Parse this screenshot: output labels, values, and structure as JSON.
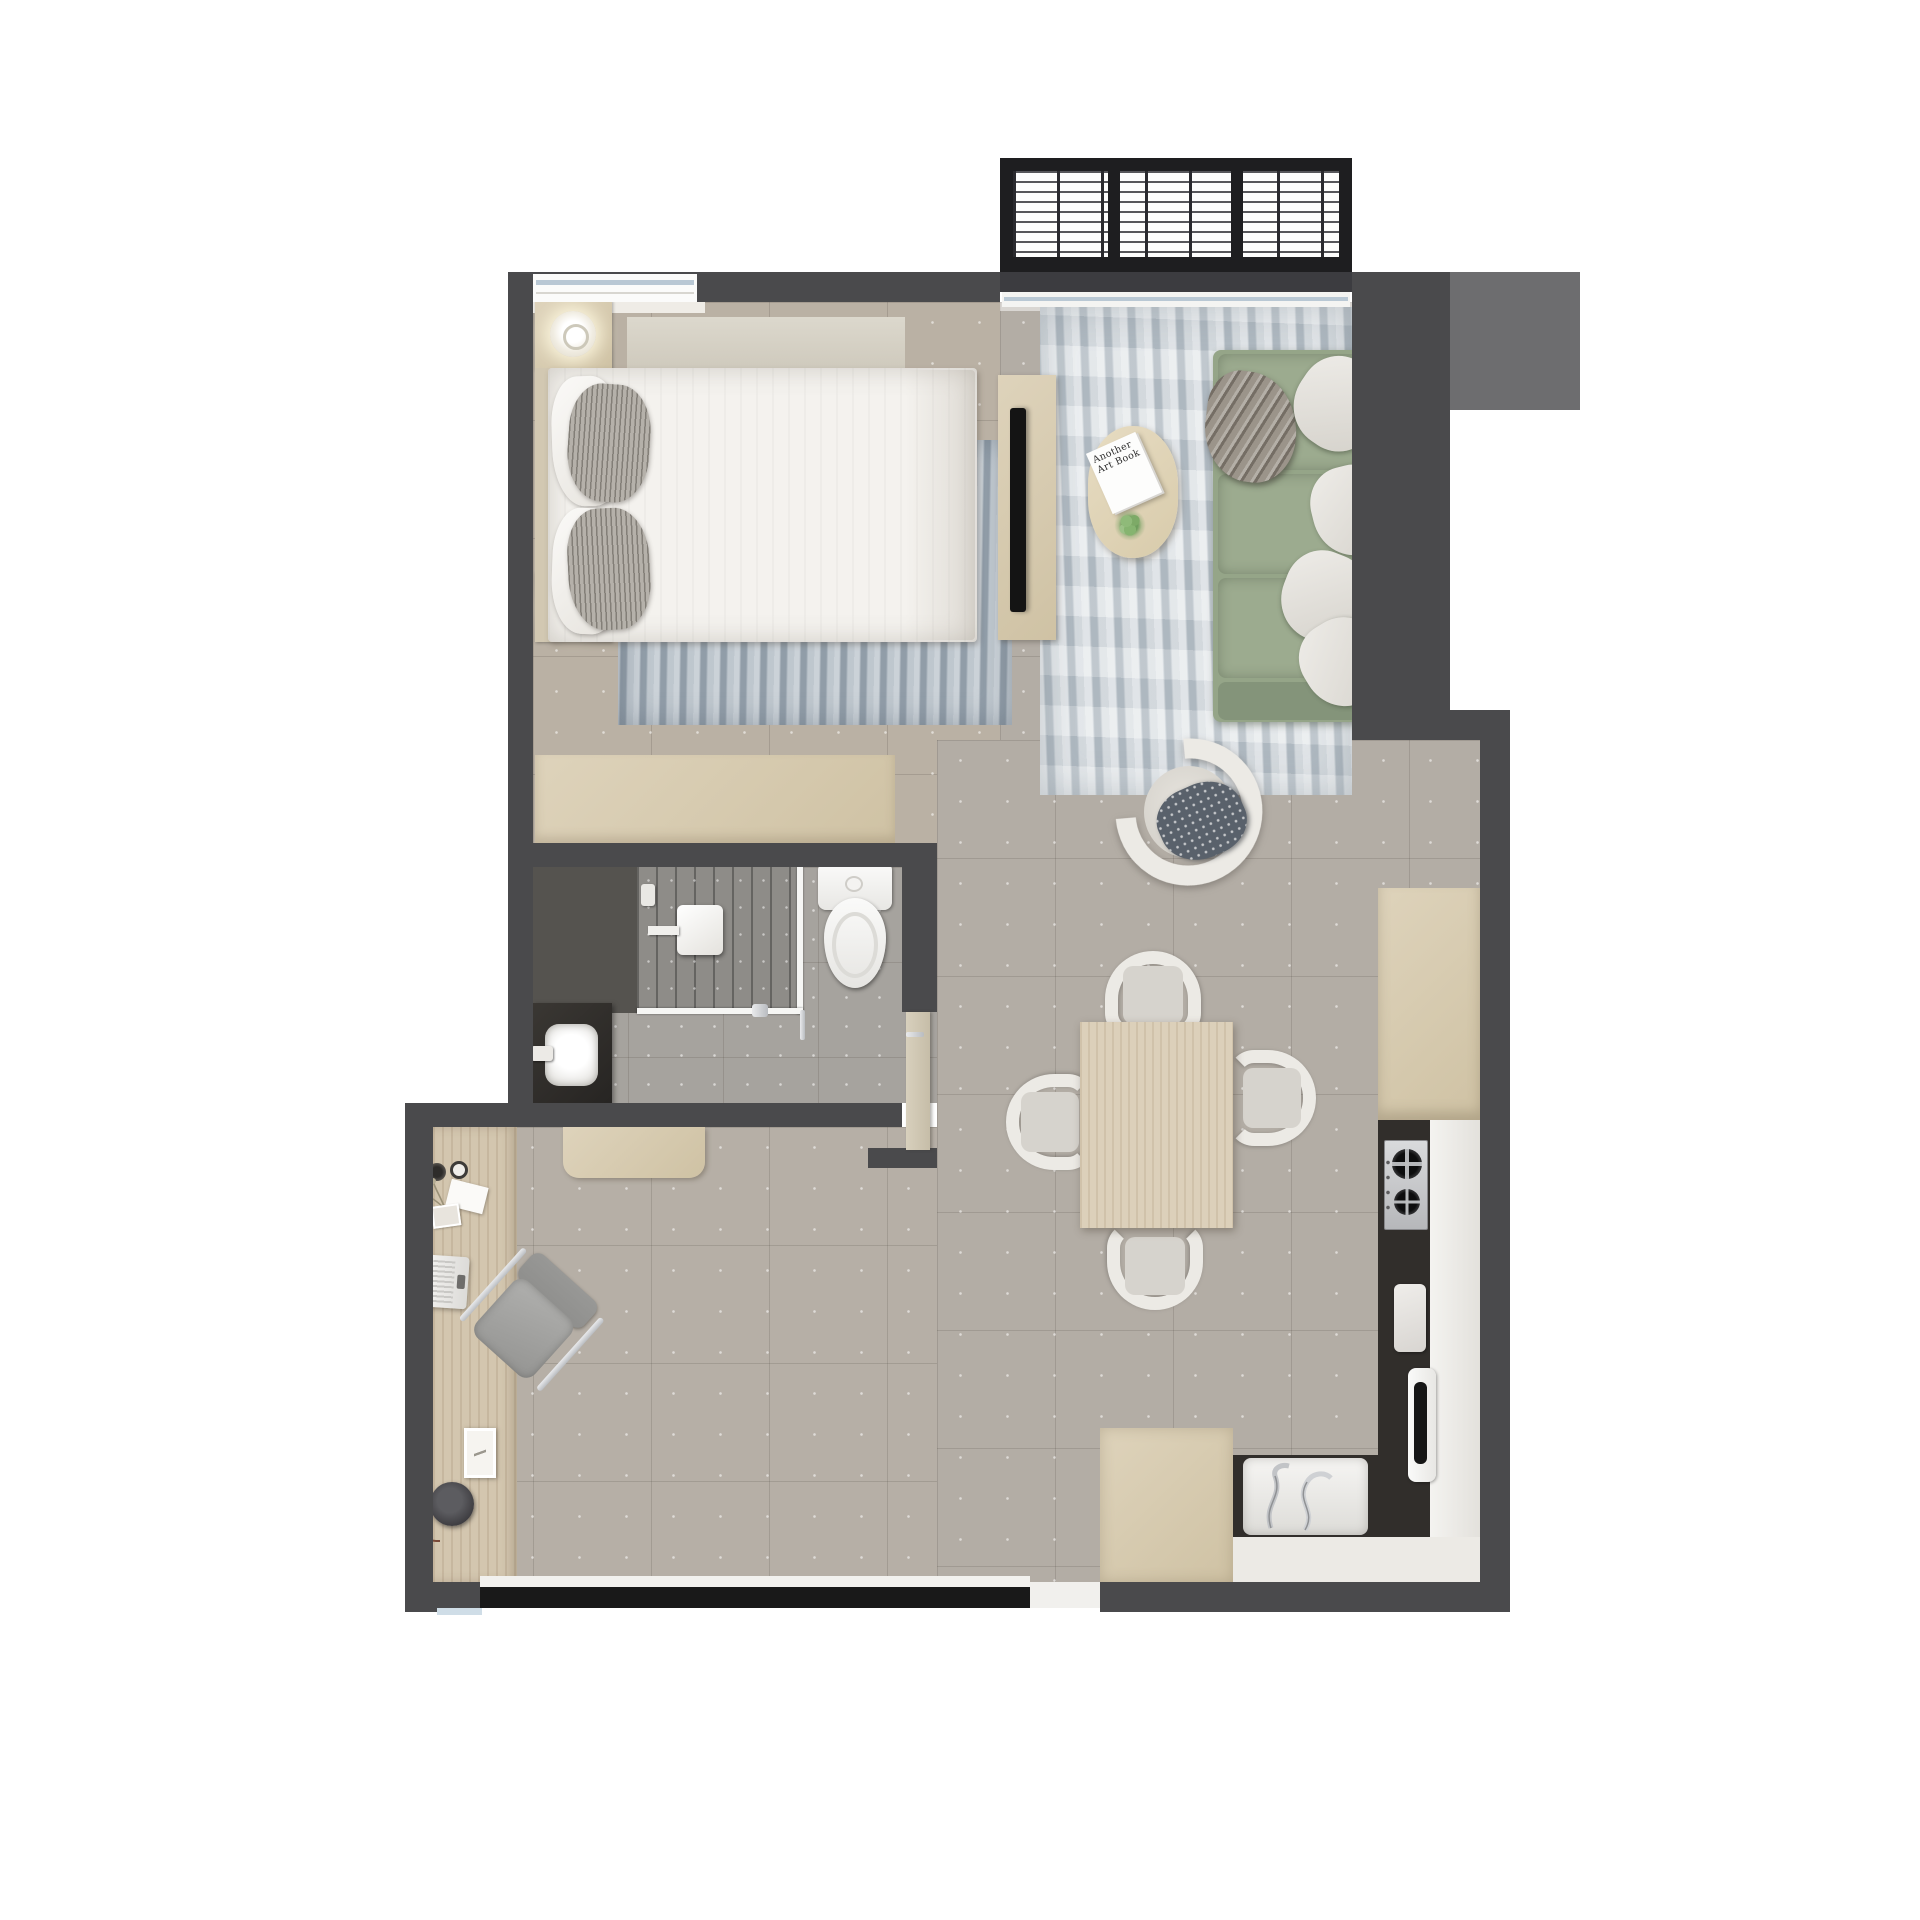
{
  "meta": {
    "title": "Studio apartment floor plan – top-down 3D render",
    "view": "top-down",
    "visible_text": [
      "Another Art Book"
    ]
  },
  "colors": {
    "wall": "#4a4a4c",
    "wallLight": "#6d6d6f",
    "floorMain": "#b3ada5",
    "floorBed": "#bab1a4",
    "floorBath": "#a6a39e",
    "showerFloor": "#8e8c88",
    "cream": "#ded3bb",
    "creamDark": "#cfc2a4",
    "wood": "#d3c6af",
    "tableWood": "#dcd0ba",
    "sofa": "#95a588",
    "sofaDark": "#84947a",
    "sofaSeat": "#9cab8f",
    "rugLiving": "#c7cfd5",
    "rugBed": "#a9b4be",
    "pillowStripe": "#b5b1aa",
    "chairShell": "#eceae5",
    "chairSeat": "#d6d3cd",
    "counterDark": "#312e2b",
    "doorBand": "#191919",
    "doorLeaf": "#d8d0bd",
    "glassBlue": "#b9c8d4",
    "deskChairGray": "#a1a19f"
  },
  "structure": {
    "walls": [
      "top-wall",
      "left-wall",
      "right-wall",
      "bathroom-walls",
      "bottom-wall"
    ],
    "openings": [
      "bedroom-window",
      "balcony-sliding-door",
      "bottom-sliding-door",
      "bathroom-door"
    ]
  },
  "rooms": [
    {
      "id": "balcony",
      "name": "Balcony",
      "furniture": [
        "slatted-railing"
      ]
    },
    {
      "id": "bedroom",
      "name": "Bedroom",
      "furniture": [
        "double-bed",
        "pillows-white-2",
        "pillows-striped-2",
        "headboard",
        "nightstand-2",
        "table-lamp-2",
        "area-rug",
        "dresser",
        "tv-console",
        "tv"
      ]
    },
    {
      "id": "living_room",
      "name": "Living room",
      "furniture": [
        "sofa-green",
        "sofa-pillows-4",
        "throw-blanket",
        "swivel-armchair",
        "accent-cushion",
        "coffee-table",
        "book",
        "plant",
        "area-rug"
      ]
    },
    {
      "id": "dining",
      "name": "Dining area",
      "furniture": [
        "dining-table",
        "dining-chair-4"
      ]
    },
    {
      "id": "kitchen",
      "name": "Kitchen",
      "furniture": [
        "tall-cabinet",
        "countertop-dark",
        "countertop-white",
        "gas-hob-2-burner",
        "cutting-board",
        "sink",
        "faucet-black",
        "washing-machine",
        "island-cabinet"
      ]
    },
    {
      "id": "bathroom",
      "name": "Bathroom",
      "furniture": [
        "walk-in-shower",
        "rain-shower-head",
        "glass-screen",
        "toilet",
        "vanity-dark",
        "basin",
        "door-leaf"
      ]
    },
    {
      "id": "study",
      "name": "Study nook",
      "furniture": [
        "desk",
        "laptop",
        "desk-chair",
        "desk-lamp",
        "picture-frame",
        "vase-dried-flowers",
        "cups",
        "console-bench"
      ]
    }
  ],
  "living_room": {
    "coffee_table": {
      "book_title": "Another Art Book"
    }
  },
  "counts": {
    "dining_chairs": 4,
    "hob_burners": 2,
    "bed_pillows": 4,
    "sofa_pillows": 4,
    "table_lamps": 2
  }
}
